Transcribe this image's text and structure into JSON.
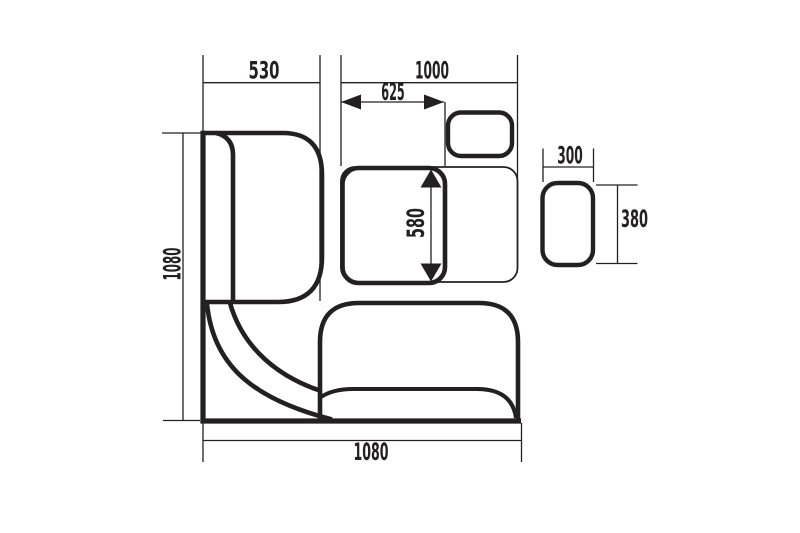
{
  "drawing": {
    "background": "#ffffff",
    "line_color": "#242021",
    "dim_labels": {
      "left_bench_width": "530",
      "right_section_width": "1000",
      "table_width": "625",
      "table_depth": "580",
      "stool_width": "300",
      "stool_depth": "380",
      "left_side_height": "1080",
      "bottom_side_width": "1080"
    }
  }
}
